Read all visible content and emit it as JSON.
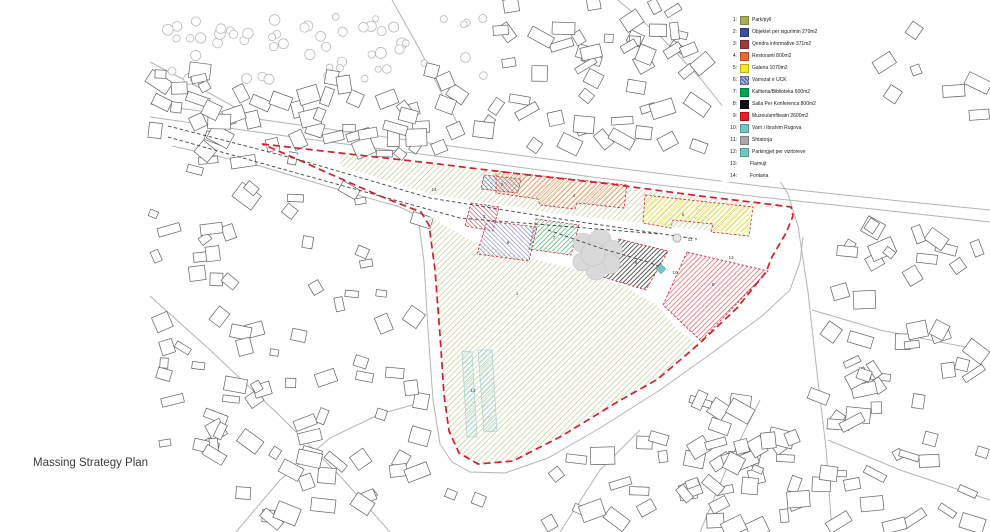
{
  "caption": "Massing Strategy Plan",
  "legend": {
    "items": [
      {
        "num": "1:",
        "label": "Park/pyll",
        "color": "#a6b052",
        "hatched": false
      },
      {
        "num": "2:",
        "label": "Objektet per sigurimin 270m2",
        "color": "#3a4ea0",
        "hatched": false
      },
      {
        "num": "3:",
        "label": "Qendra informative 371m2",
        "color": "#9e3a40",
        "hatched": false
      },
      {
        "num": "4:",
        "label": "Restoranti 800m2",
        "color": "#f26a2b",
        "hatched": false
      },
      {
        "num": "5:",
        "label": "Galeria 1070m2",
        "color": "#f5e926",
        "hatched": false
      },
      {
        "num": "6:",
        "label": "Varrezat e UCK",
        "color": "#6d74b8",
        "hatched": true
      },
      {
        "num": "7:",
        "label": "Kafiteria/Biblioteka 600m2",
        "color": "#00a651",
        "hatched": false
      },
      {
        "num": "8:",
        "label": "Salla Per Konferenca 800m2",
        "color": "#111111",
        "hatched": false
      },
      {
        "num": "9:",
        "label": "Muzeu/amfiteatri 2600m2",
        "color": "#ec1c24",
        "hatched": false
      },
      {
        "num": "10:",
        "label": "Varri i Ibrahim Rugova",
        "color": "#72c7c3",
        "hatched": false
      },
      {
        "num": "11:",
        "label": "Shtatorja",
        "color": "#a8a8a8",
        "hatched": false
      },
      {
        "num": "12:",
        "label": "Parkingjet per vizitoreve",
        "color": "#72c7c3",
        "hatched": false
      },
      {
        "num": "13:",
        "label": "Flamujt",
        "color": null,
        "hatched": false
      },
      {
        "num": "14:",
        "label": "Fontana",
        "color": null,
        "hatched": false
      }
    ]
  },
  "map_labels": [
    {
      "text": "1",
      "x": 517,
      "y": 295
    },
    {
      "text": "2",
      "x": 502,
      "y": 186
    },
    {
      "text": "3",
      "x": 484,
      "y": 218
    },
    {
      "text": "4",
      "x": 574,
      "y": 197
    },
    {
      "text": "5",
      "x": 683,
      "y": 216
    },
    {
      "text": "6",
      "x": 508,
      "y": 244
    },
    {
      "text": "7",
      "x": 554,
      "y": 239
    },
    {
      "text": "8",
      "x": 636,
      "y": 264
    },
    {
      "text": "9",
      "x": 713,
      "y": 286
    },
    {
      "text": "10",
      "x": 675,
      "y": 274
    },
    {
      "text": "11",
      "x": 690,
      "y": 241
    },
    {
      "text": "12",
      "x": 473,
      "y": 392
    },
    {
      "text": "13",
      "x": 731,
      "y": 259
    },
    {
      "text": "14",
      "x": 434,
      "y": 191
    }
  ],
  "colors": {
    "boundary": "#cf2030",
    "axis": "#404040",
    "road": "#b4b4b4",
    "building": "#606060",
    "tree": "#b8b8b8",
    "cloud": "#d9d9d9",
    "park_hatch": "#b5bd75",
    "label": "#3a3a3a"
  }
}
